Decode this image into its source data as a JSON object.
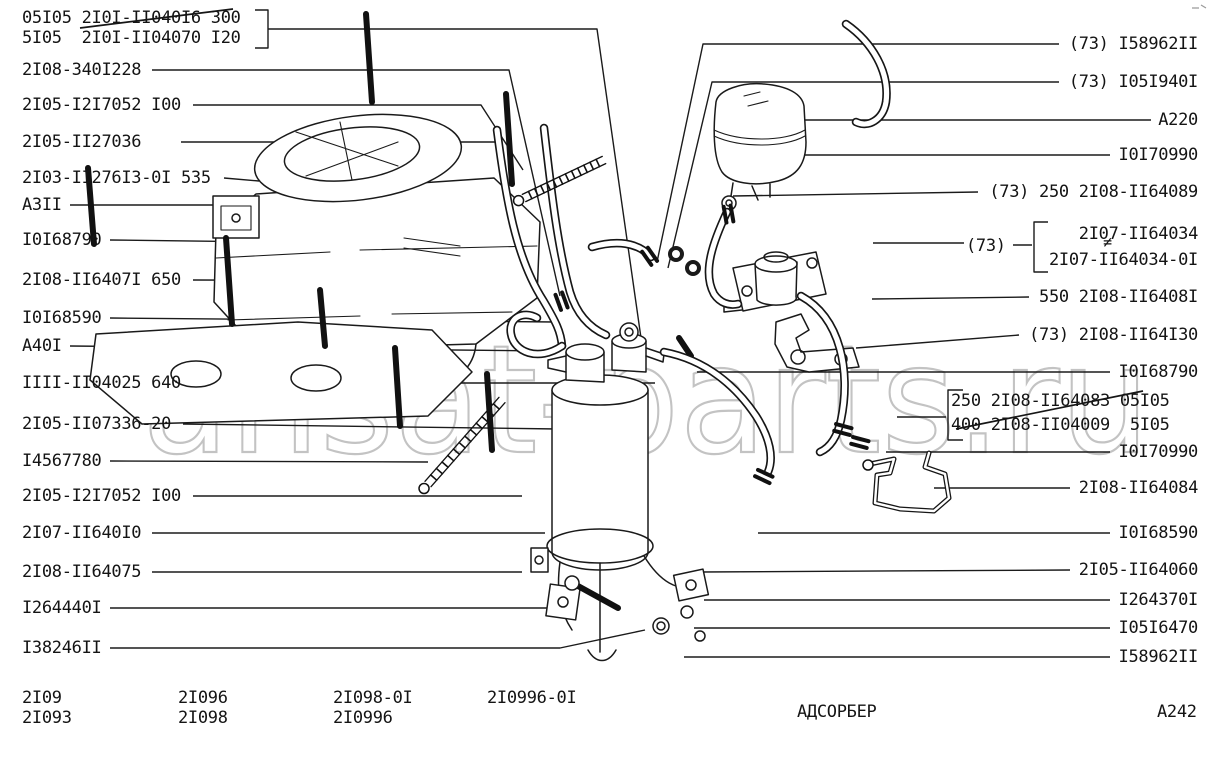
{
  "watermark": "ansat-parts.ru",
  "title": "АДСОРБЕР",
  "sheet_code": "A242",
  "left_labels": [
    {
      "text": "05I05 2I0I-II040I6 300",
      "struck": true
    },
    {
      "text": "5I05  2I0I-II04070 I20",
      "struck": false
    },
    {
      "text": "2I08-340I228",
      "struck": false
    },
    {
      "text": "2I05-I2I7052 I00",
      "struck": false
    },
    {
      "text": "2I05-II27036",
      "struck": false
    },
    {
      "text": "2I03-II276I3-0I 535",
      "struck": false
    },
    {
      "text": "A3II",
      "struck": false
    },
    {
      "text": "I0I68790",
      "struck": false
    },
    {
      "text": "2I08-II6407I 650",
      "struck": false
    },
    {
      "text": "I0I68590",
      "struck": false
    },
    {
      "text": "A40I",
      "struck": false
    },
    {
      "text": "IIII-II04025 640",
      "struck": false
    },
    {
      "text": "2I05-II07336-20",
      "struck": false
    },
    {
      "text": "I4567780",
      "struck": false
    },
    {
      "text": "2I05-I2I7052 I00",
      "struck": false
    },
    {
      "text": "2I07-II640I0",
      "struck": false
    },
    {
      "text": "2I08-II64075",
      "struck": false
    },
    {
      "text": "I264440I",
      "struck": false
    },
    {
      "text": "I38246II",
      "struck": false
    }
  ],
  "right_labels": [
    {
      "text": "(73) I58962II"
    },
    {
      "text": "(73) I05I940I"
    },
    {
      "text": "A220"
    },
    {
      "text": "I0I70990"
    },
    {
      "text": "(73) 250 2I08-II64089"
    },
    {
      "text": "550 2I08-II6408I"
    },
    {
      "text": "(73) 2I08-II64I30"
    },
    {
      "text": "I0I68790"
    },
    {
      "text": "I0I70990"
    },
    {
      "text": "2I08-II64084"
    },
    {
      "text": "I0I68590"
    },
    {
      "text": "2I05-II64060"
    },
    {
      "text": "I264370I"
    },
    {
      "text": "I05I6470"
    },
    {
      "text": "I58962II"
    }
  ],
  "alt_group_73": {
    "prefix": "(73)",
    "neq": "≠",
    "options": [
      "2I07-II64034",
      "2I07-II64034-0I"
    ]
  },
  "range_group": {
    "rows": [
      {
        "text": "250 2I08-II64083 05I05",
        "struck": true
      },
      {
        "text": "400 2I08-II04009  5I05",
        "struck": false
      }
    ]
  },
  "models": {
    "columns": [
      {
        "lines": [
          "2I09",
          "2I093"
        ]
      },
      {
        "lines": [
          "2I096",
          "2I098"
        ]
      },
      {
        "lines": [
          "2I098-0I",
          "2I0996"
        ]
      },
      {
        "lines": [
          "2I0996-0I"
        ]
      }
    ]
  }
}
